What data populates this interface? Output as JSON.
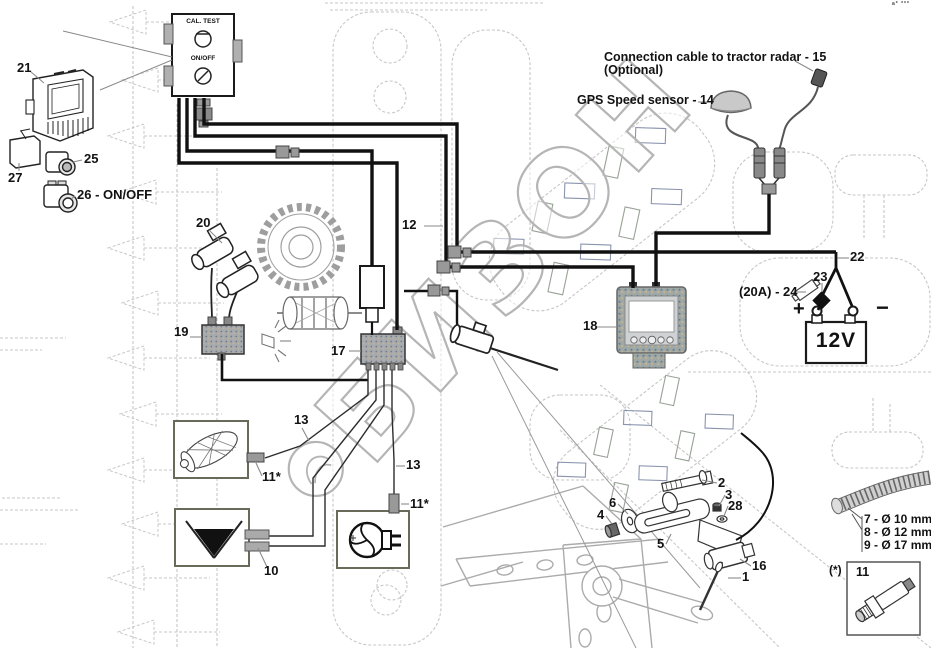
{
  "watermark": {
    "text": "БИЗОН"
  },
  "corner_mark": "a* ***",
  "control_box": {
    "cal_test_label": "CAL. TEST",
    "on_off_label": "ON/OFF"
  },
  "annotations": {
    "radar_cable_label": "Connection cable to tractor radar - 15",
    "radar_cable_note": "(Optional)",
    "gps_sensor_label": "GPS Speed sensor - 14",
    "fuse_label": "(20A) - 24",
    "hose_size_7": "7 - Ø 10 mm",
    "hose_size_8": "8 - Ø 12 mm",
    "hose_size_9": "9 - Ø 17 mm",
    "spare_sensor_note": "(*)",
    "spare_sensor_number": "11"
  },
  "battery": {
    "voltage_label": "12V",
    "plus_label": "+",
    "minus_label": "−"
  },
  "callouts": {
    "n1": "1",
    "n2": "2",
    "n3": "3",
    "n4": "4",
    "n5": "5",
    "n6": "6",
    "n10": "10",
    "n11_roller": "11*",
    "n11_fan": "11*",
    "n12": "12",
    "n13_left": "13",
    "n13_right": "13",
    "n16": "16",
    "n17": "17",
    "n18": "18",
    "n19": "19",
    "n20": "20",
    "n21": "21",
    "n22": "22",
    "n23": "23",
    "n25": "25",
    "n26": "26 - ON/OFF",
    "n27": "27",
    "n28": "28"
  },
  "colors": {
    "cable_black": "#111111",
    "watermark_gray": "#b5b5b5",
    "tread_blue": "#8a94ae",
    "background_gray": "#c7c7c7"
  }
}
